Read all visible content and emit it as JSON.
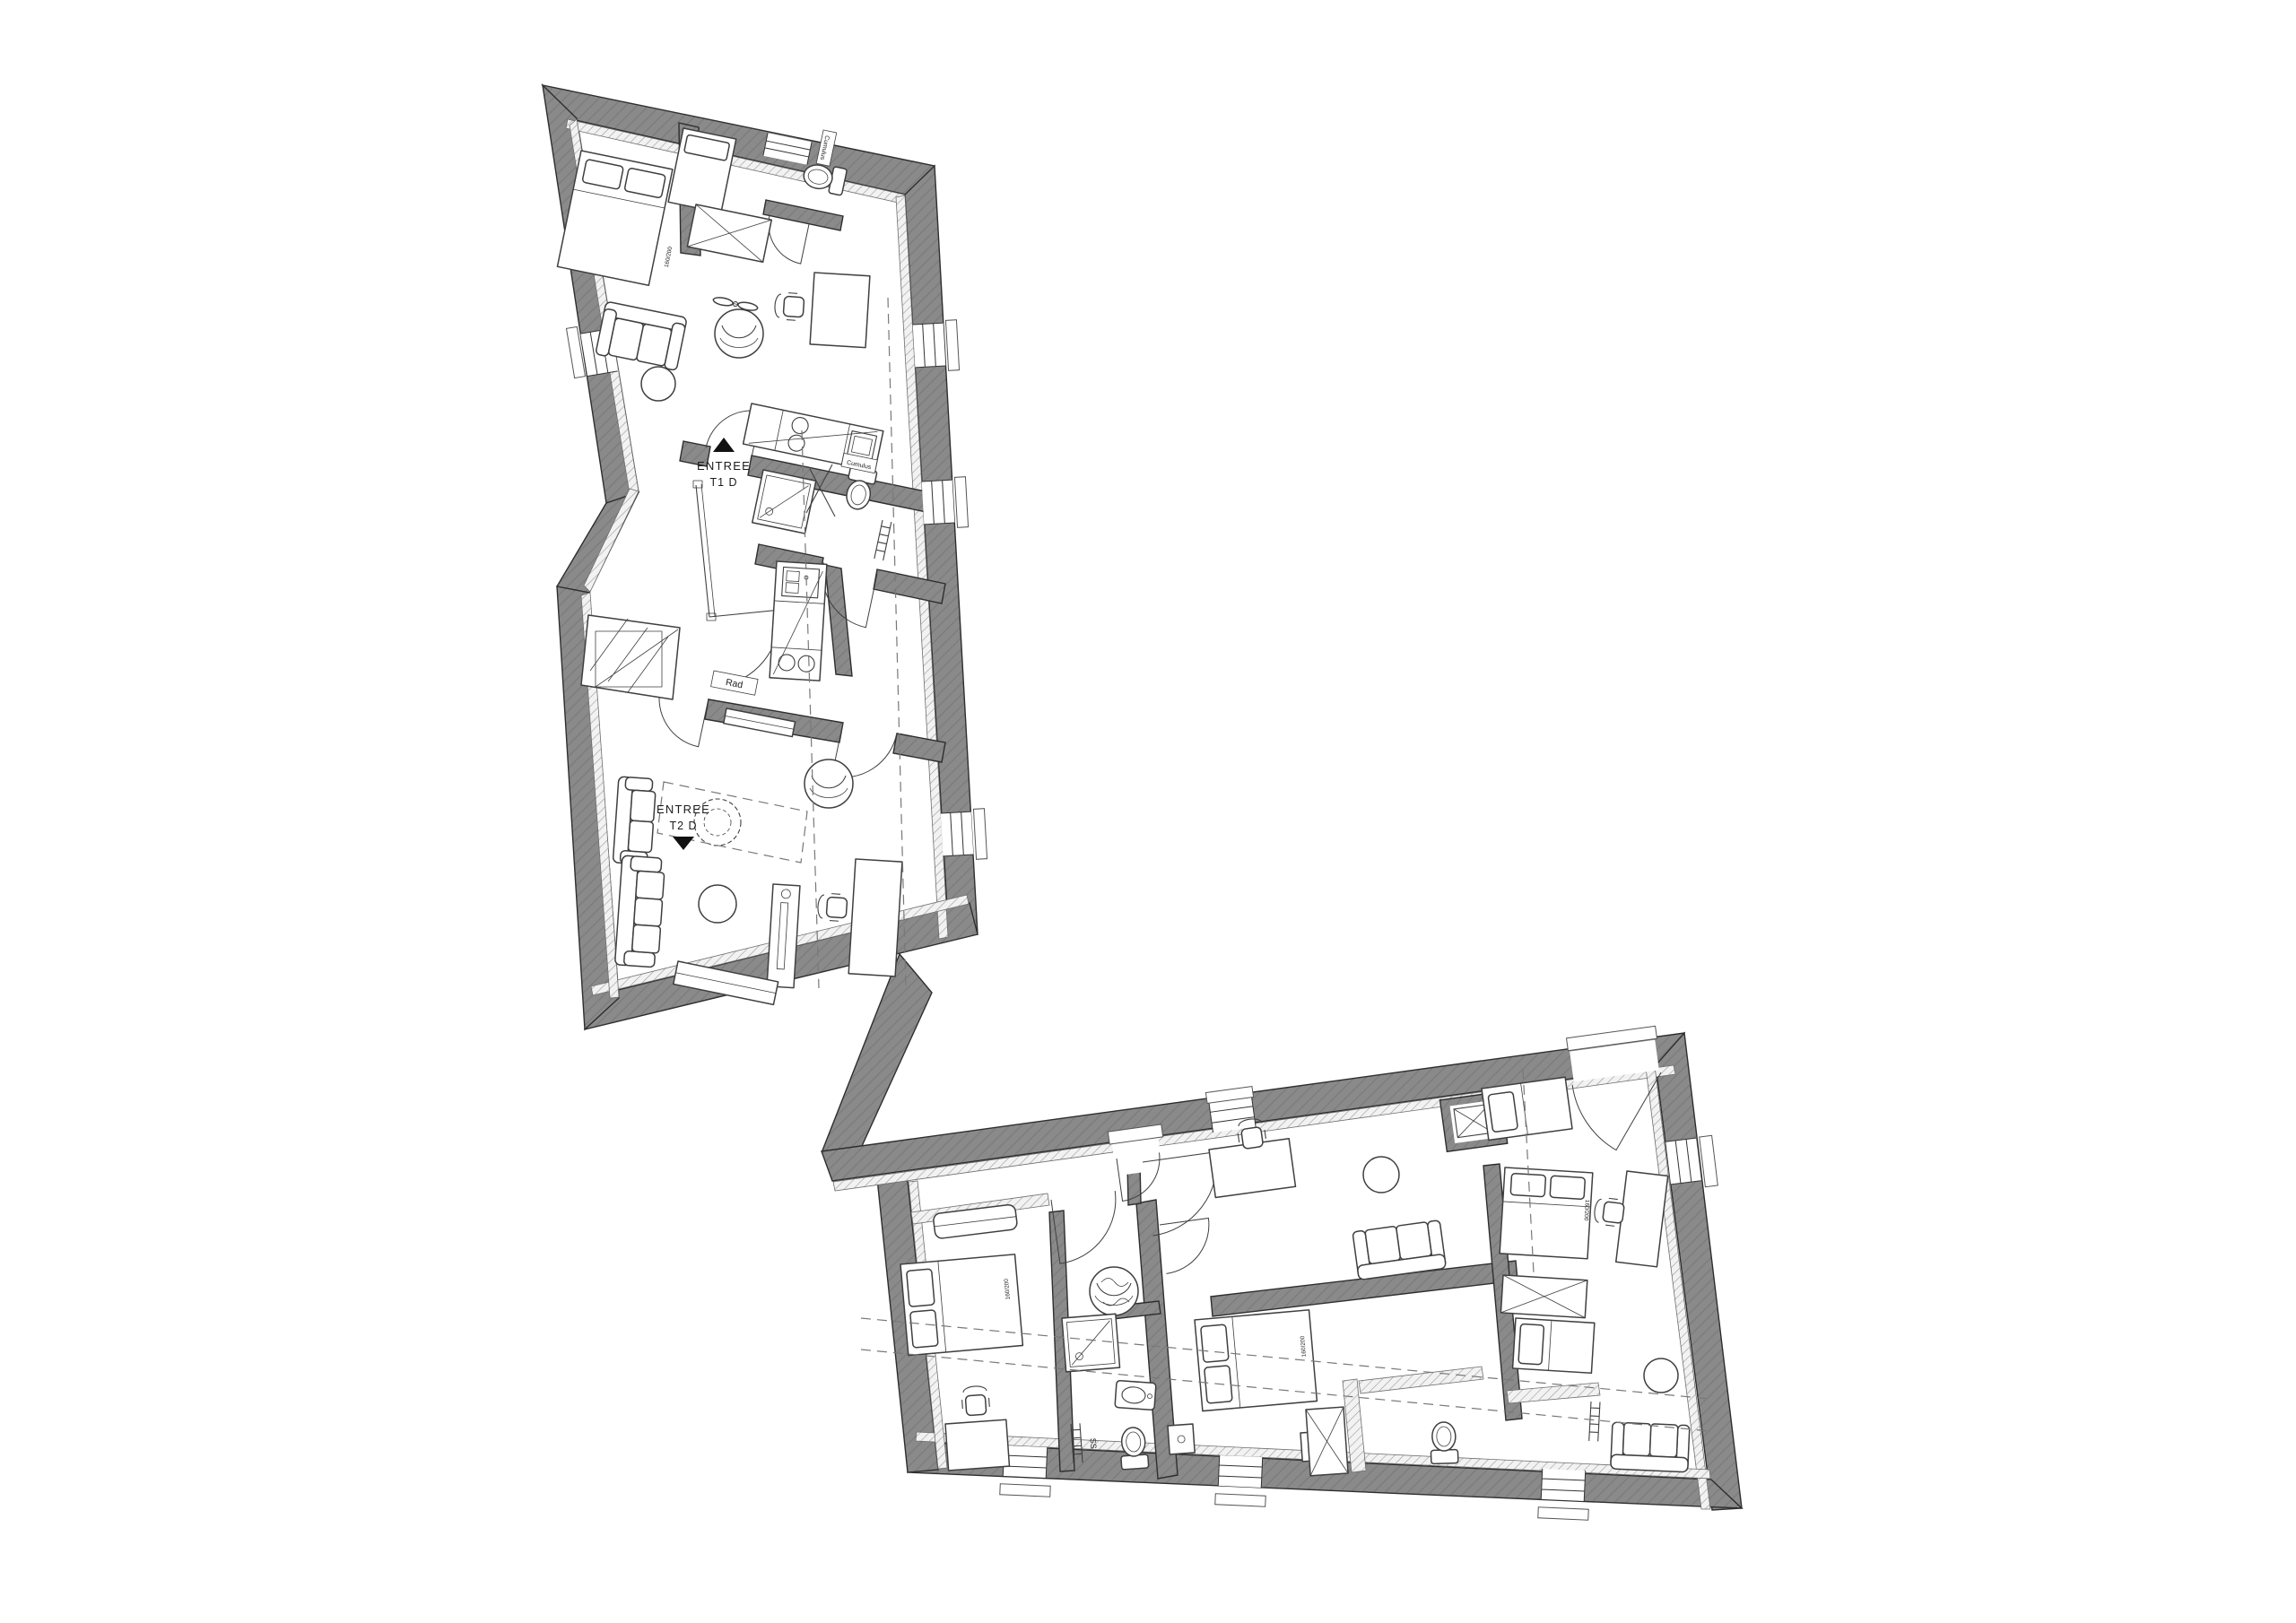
{
  "plan": {
    "colors": {
      "background": "#ffffff",
      "wall_fill": "#8a8a8a",
      "wall_hatch": "#7d7d7d",
      "wall_edge": "#2e2e2e",
      "line": "#3f3f3f",
      "insulation_fill": "#f2f2f2",
      "insulation_hatch": "#9b9b9b",
      "dash": "#787878",
      "label": "#1b1b1b"
    },
    "labels": {
      "entry_t1": {
        "line1": "ENTREE",
        "line2": "T1 D"
      },
      "entry_t2": {
        "line1": "ENTREE",
        "line2": "T2 D"
      },
      "radiator": "Rad",
      "water_heater": "Cumulus",
      "towel_dryer": "SS",
      "bed_size": "160/200"
    },
    "symbols": [
      "double-bed",
      "single-bed",
      "wardrobe-cross",
      "sofa",
      "armchair",
      "desk",
      "office-chair",
      "round-table",
      "plant",
      "toilet",
      "shower",
      "sink",
      "kitchen-counter",
      "stairs",
      "radiator",
      "towel-radiator",
      "tv-stand",
      "window",
      "door-swing",
      "ceiling-fan",
      "nightstand",
      "stair-flight"
    ]
  }
}
